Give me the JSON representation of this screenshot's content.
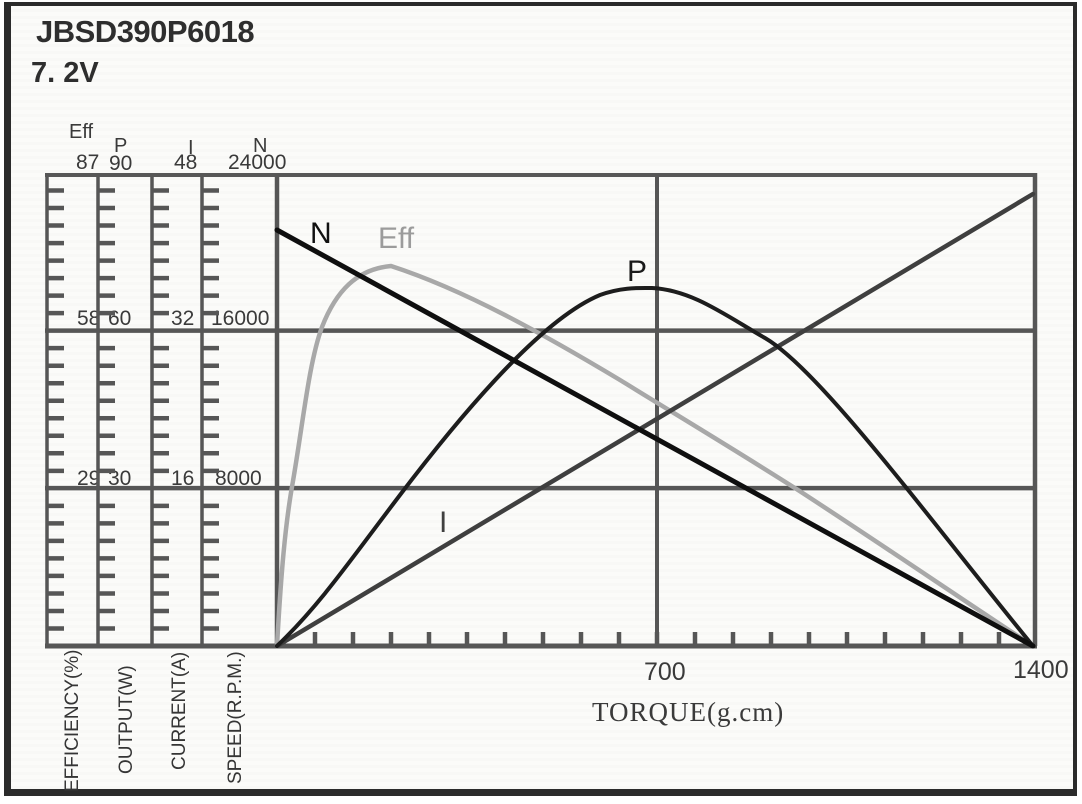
{
  "header": {
    "model": "JBSD390P6018",
    "voltage": "7. 2V"
  },
  "scales": [
    {
      "name": "Eff",
      "max": "87",
      "mid": "58",
      "low": "29",
      "axis_label": "EFFICIENCY(%)"
    },
    {
      "name": "P",
      "max": "90",
      "mid": "60",
      "low": "30",
      "axis_label": "OUTPUT(W)"
    },
    {
      "name": "I",
      "max": "48",
      "mid": "32",
      "low": "16",
      "axis_label": "CURRENT(A)"
    },
    {
      "name": "N",
      "max": "24000",
      "mid": "16000",
      "low": "8000",
      "axis_label": "SPEED(R.P.M.)"
    }
  ],
  "x_axis": {
    "title": "TORQUE(g.cm)",
    "mid_tick": "700",
    "max_tick": "1400"
  },
  "curve_labels": {
    "n": "N",
    "eff": "Eff",
    "p": "P",
    "i": "I"
  },
  "colors": {
    "n": "#0f0f0f",
    "p": "#1d1d1d",
    "i": "#3f3f3f",
    "eff": "#a8a8a8",
    "eff_label": "#9b9b9b",
    "grid": "#565656",
    "text": "#3a3a3a"
  },
  "chart_data": {
    "type": "line",
    "title": "JBSD390P6018 7.2V motor performance curves",
    "xlabel": "TORQUE(g.cm)",
    "x_range": [
      0,
      1400
    ],
    "x_major_ticks": [
      700,
      1400
    ],
    "x_minor_tick_step": 70,
    "grid": true,
    "legend_position": "inline-labels",
    "x": [
      0,
      175,
      350,
      525,
      700,
      875,
      1050,
      1225,
      1400
    ],
    "series": [
      {
        "name": "N",
        "unit": "SPEED(R.P.M.)",
        "axis_range": [
          0,
          24000
        ],
        "axis_ticks": [
          8000,
          16000,
          24000
        ],
        "values": [
          21200,
          18600,
          16000,
          13300,
          10600,
          8000,
          5300,
          2700,
          0
        ]
      },
      {
        "name": "Eff",
        "unit": "EFFICIENCY(%)",
        "axis_range": [
          0,
          87
        ],
        "axis_ticks": [
          29,
          58,
          87
        ],
        "values": [
          0,
          70,
          66,
          56,
          46,
          35,
          23,
          12,
          0
        ]
      },
      {
        "name": "P",
        "unit": "OUTPUT(W)",
        "axis_range": [
          0,
          90
        ],
        "axis_ticks": [
          30,
          60,
          90
        ],
        "values": [
          0,
          22,
          46,
          63,
          69,
          61,
          47,
          24,
          0
        ]
      },
      {
        "name": "I",
        "unit": "CURRENT(A)",
        "axis_range": [
          0,
          48
        ],
        "axis_ticks": [
          16,
          32,
          48
        ],
        "values": [
          0,
          5.7,
          11.5,
          17.2,
          23,
          28.7,
          34.5,
          40.2,
          46
        ]
      }
    ]
  }
}
